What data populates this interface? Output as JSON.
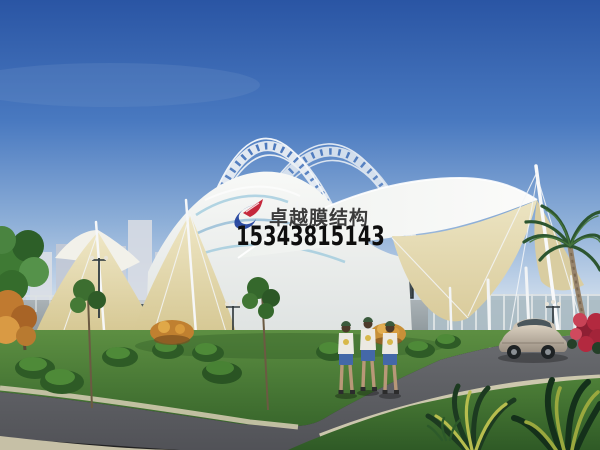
{
  "watermark": {
    "company_name": "卓越膜结构",
    "phone_number": "15343815143",
    "logo_icon": "sail-swoosh-logo",
    "text_color": "#3c3c3c",
    "phone_color": "#0e0e0e",
    "logo_blue": "#1d3f9c",
    "logo_red": "#c5283c"
  },
  "scene": {
    "type": "architectural-rendering",
    "subject": "white tensile membrane entrance canopy with lattice arch trusses",
    "elements": [
      "blue-sky",
      "lattice-arch-truss",
      "white-membrane-sails",
      "cream-membrane-underside",
      "support-masts",
      "tension-cables",
      "city-skyline",
      "perimeter-wall",
      "plaza-steps",
      "street-lamps",
      "sign-board",
      "lawn",
      "shrubs",
      "ornamental-trees",
      "autumn-tree",
      "palm-tree",
      "red-flower-bush",
      "orange-flower-bush",
      "sedan-car",
      "three-pedestrians",
      "asphalt-road",
      "concrete-curb",
      "foreground-plants"
    ],
    "palette": {
      "sky_top": "#2a55a4",
      "sky_horizon": "#e2eaf2",
      "membrane_white": "#f4f5f2",
      "membrane_cream": "#e6ddb8",
      "membrane_stripe_aqua": "#8fc3da",
      "truss_white": "#e9eef4",
      "wall_gray": "#9aa4a8",
      "dark_wall_panel": "#4e5a5e",
      "lawn_green": "#4e8038",
      "road_gray": "#5c5e63",
      "curb_tan": "#cfc9ae",
      "car_beige": "#c9bead",
      "shorts_blue": "#4468a8",
      "palm_green": "#2c5530",
      "flower_red": "#b3293f",
      "flower_orange": "#c08030"
    }
  }
}
